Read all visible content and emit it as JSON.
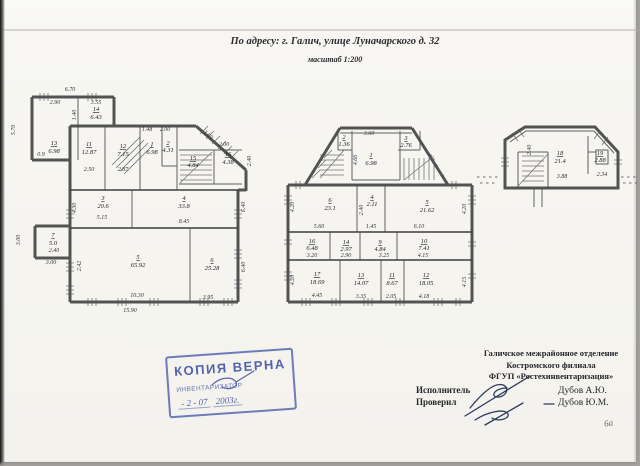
{
  "doc": {
    "title": "По адресу: г. Галич, улице Луначарского д. 32",
    "scale": "масштаб 1:200",
    "page_mark": "6а"
  },
  "colors": {
    "stamp_blue": "#4456a2",
    "ink_blue": "#2c3a5e",
    "wall_gray": "#3c3c3e"
  },
  "stamp": {
    "title": "КОПИЯ ВЕРНА",
    "role": "ИНВЕНТАРИЗАТОР",
    "date": "- 2 -  07",
    "year": "2003г."
  },
  "footer": {
    "org1": "Галичское межрайонное отделение",
    "org2": "Костромского филиала",
    "org3": "ФГУП «Ростехинвентаризация»",
    "executor": "Исполнитель",
    "checked": "Проверил",
    "name1": "Дубов А.Ю.",
    "name2": "Дубов Ю.М."
  },
  "f1": {
    "rooms": [
      {
        "n": "13",
        "a": "6.98"
      },
      {
        "n": "14",
        "a": "6.43"
      },
      {
        "n": "11",
        "a": "12.87"
      },
      {
        "n": "12",
        "a": "7.15"
      },
      {
        "n": "1",
        "a": "6.98"
      },
      {
        "n": "2",
        "a": "4.31"
      },
      {
        "n": "15",
        "a": "4.84"
      },
      {
        "n": "16",
        "a": "4.38"
      },
      {
        "n": "3",
        "a": "20.6"
      },
      {
        "n": "4",
        "a": "33.8"
      },
      {
        "n": "7",
        "a": "5.0"
      },
      {
        "n": "5",
        "a": "65.92"
      },
      {
        "n": "6",
        "a": "25.28"
      }
    ],
    "dims": [
      "6.70",
      "2.90",
      "3.55",
      "5.70",
      "1.40",
      "0.9",
      "2.50",
      "2.87",
      "1.48",
      "2.00",
      "3.60",
      "2.00",
      "2.40",
      "5.15",
      "8.45",
      "4.30",
      "6.40",
      "6.40",
      "3.00",
      "2.40",
      "3.00",
      "2.42",
      "10.30",
      "3.95",
      "15.90"
    ]
  },
  "f2": {
    "rooms": [
      {
        "n": "2",
        "a": "1.36"
      },
      {
        "n": "1",
        "a": "6.98"
      },
      {
        "n": "3",
        "a": "2.76"
      },
      {
        "n": "6",
        "a": "23.1"
      },
      {
        "n": "4",
        "a": "2.11"
      },
      {
        "n": "5",
        "a": "21.62"
      },
      {
        "n": "16",
        "a": "6.48"
      },
      {
        "n": "14",
        "a": "2.97"
      },
      {
        "n": "9",
        "a": "4.84"
      },
      {
        "n": "10",
        "a": "7.41"
      },
      {
        "n": "17",
        "a": "18.69"
      },
      {
        "n": "13",
        "a": "14.07"
      },
      {
        "n": "11",
        "a": "8.67"
      },
      {
        "n": "12",
        "a": "18.05"
      }
    ],
    "dims": [
      "3.60",
      "4.66",
      "4.20",
      "5.60",
      "2.40",
      "1.45",
      "6.10",
      "4.20",
      "3.20",
      "2.90",
      "3.25",
      "4.15",
      "4.45",
      "3.35",
      "2.05",
      "4.18",
      "4.20",
      "4.15"
    ]
  },
  "f3": {
    "rooms": [
      {
        "n": "18",
        "a": "21.4"
      },
      {
        "n": "19",
        "a": "2.88"
      }
    ],
    "dims": [
      "3.88",
      "2.34",
      "2.40"
    ]
  }
}
